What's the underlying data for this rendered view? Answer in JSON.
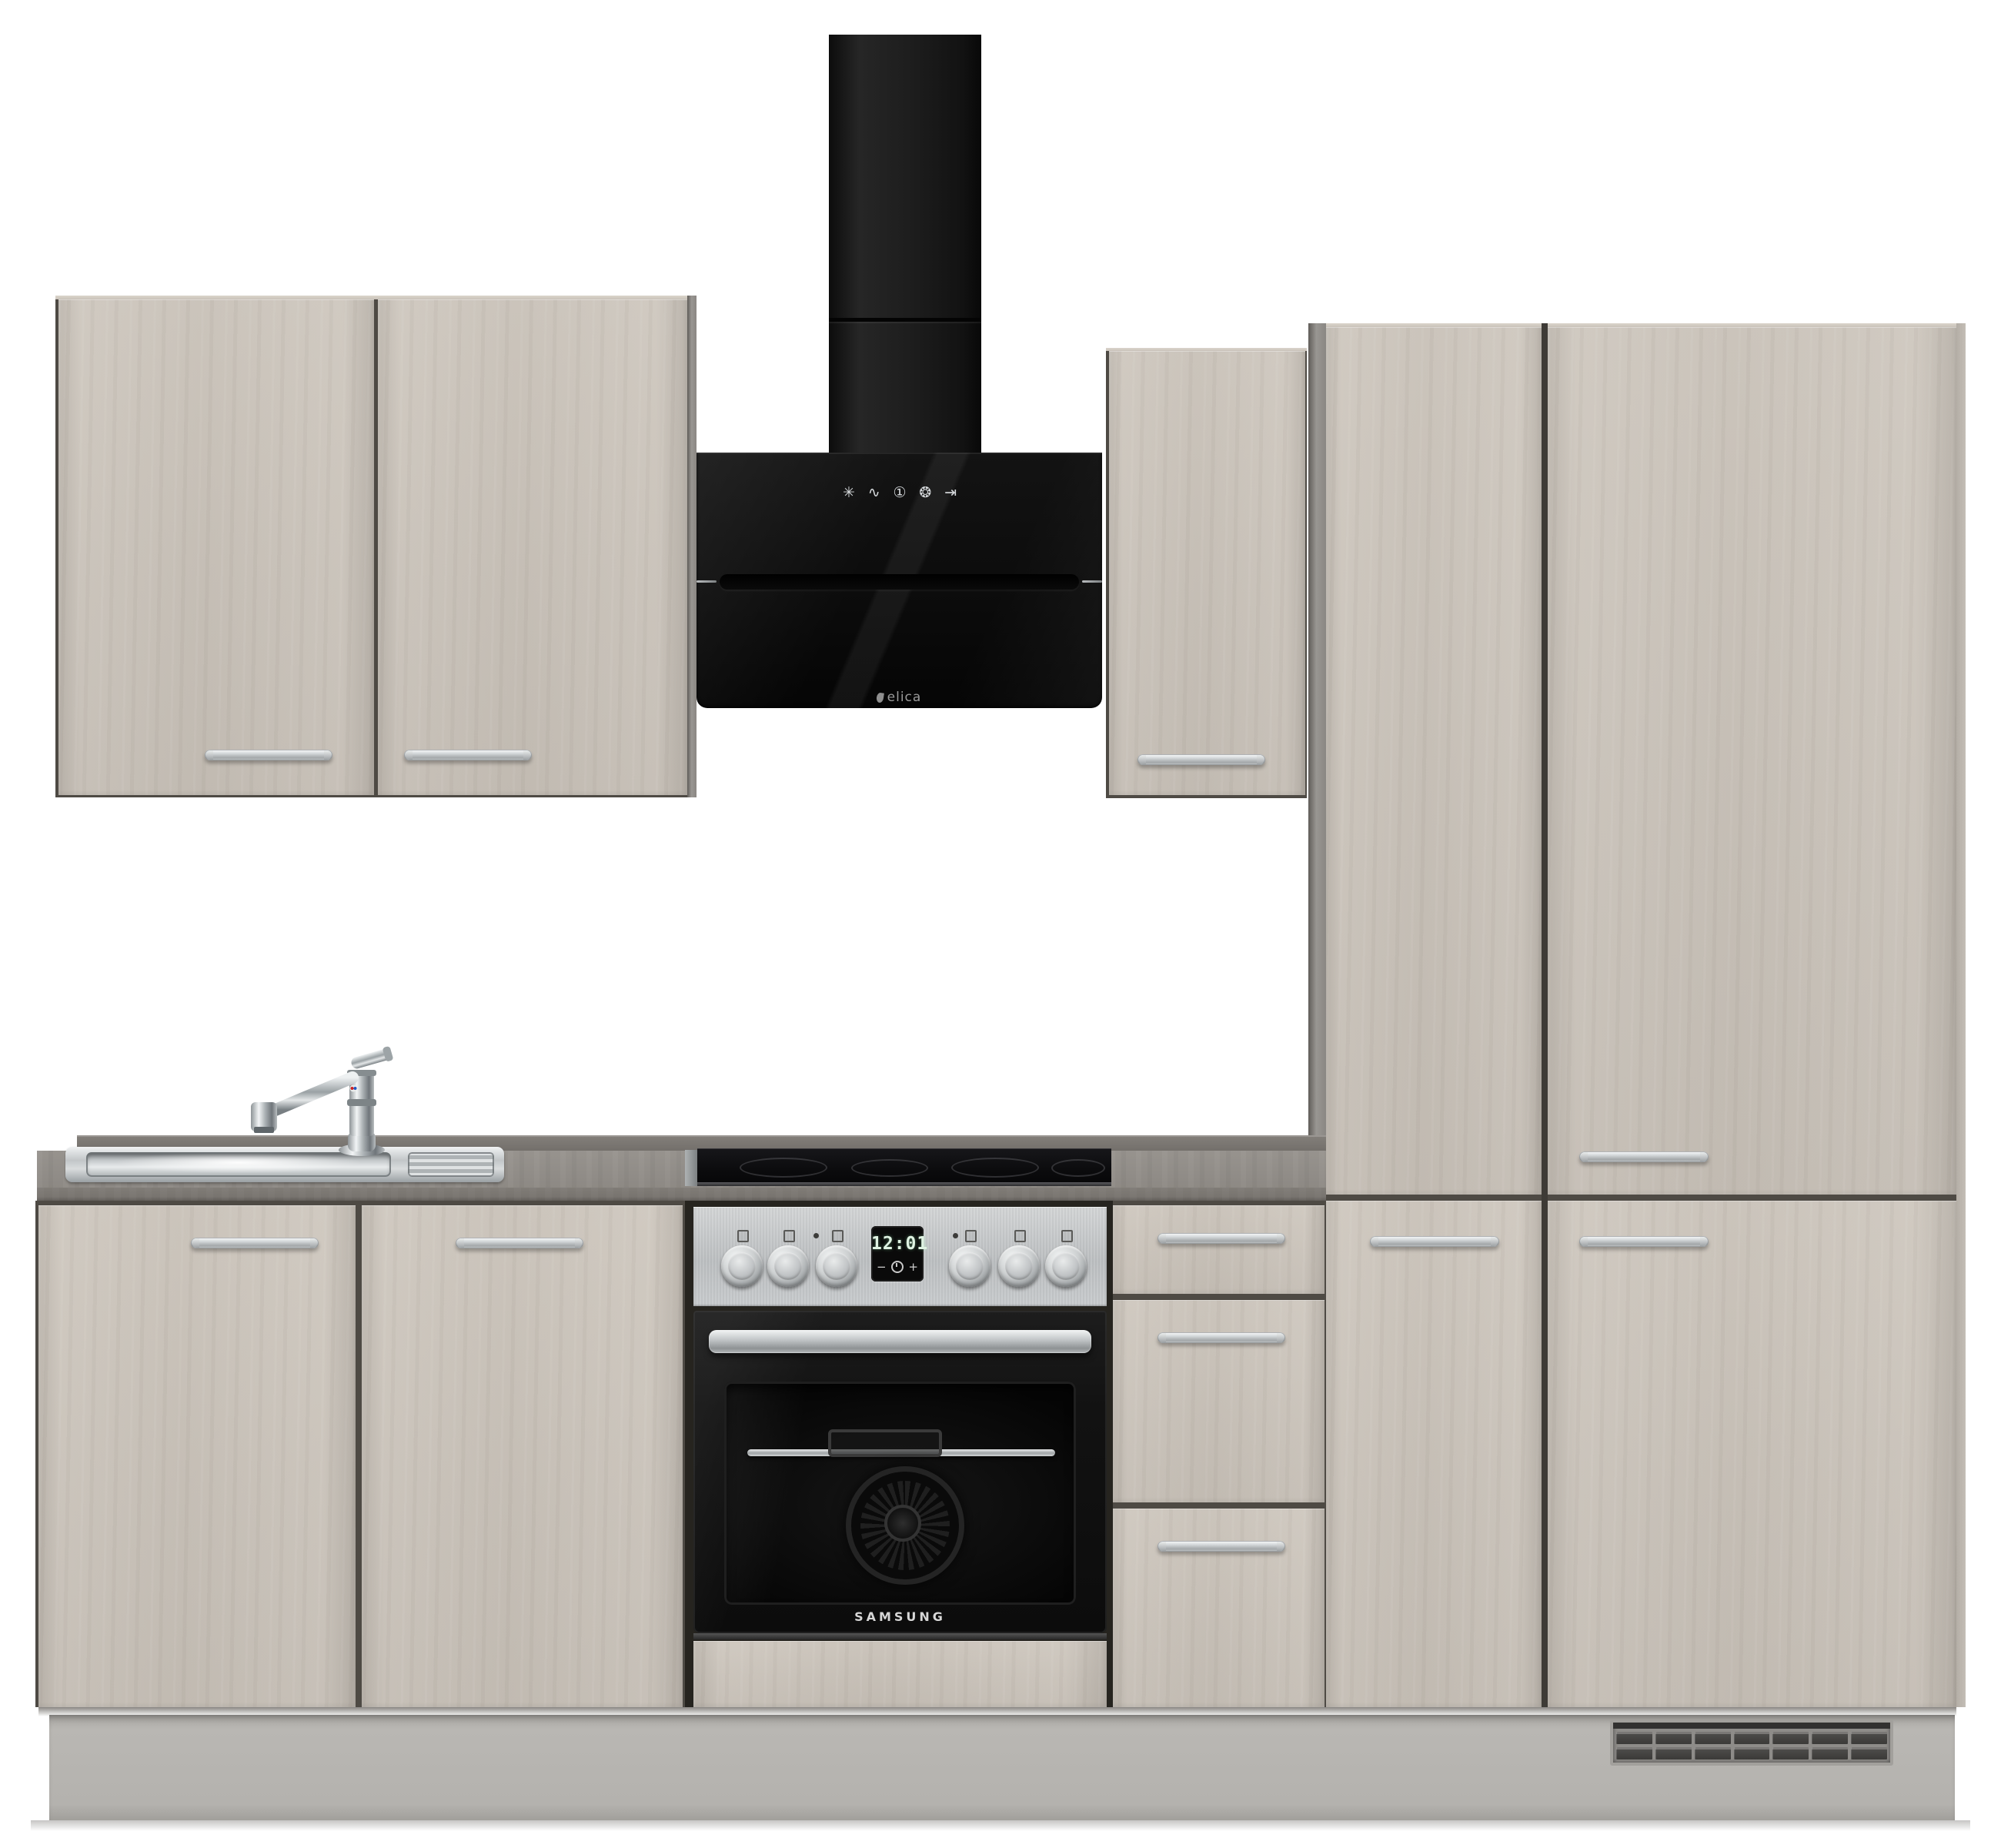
{
  "scene": {
    "type": "product-photo",
    "subject": "Kitchen unit row with appliances, concrete-beige fronts, white background",
    "background": "#ffffff"
  },
  "palette": {
    "front_concrete_beige": "#cbc4bb",
    "carcass_grey": "#8d8a86",
    "countertop_grey": "#8a8681",
    "plinth_grey": "#b8b6b2",
    "appliance_black": "#101010",
    "stainless_steel": "#c6c9cb",
    "handle_silver": "#c3c7c9"
  },
  "hood": {
    "brand": "elica",
    "style": "black glass head-free chimney hood",
    "touch_controls": [
      {
        "name": "fan-speed-icon",
        "glyph": "✳"
      },
      {
        "name": "boost-icon",
        "glyph": "∿"
      },
      {
        "name": "power-icon",
        "glyph": "①"
      },
      {
        "name": "light-icon",
        "glyph": "❂"
      },
      {
        "name": "timer-icon",
        "glyph": "⇥"
      }
    ]
  },
  "oven": {
    "brand": "SAMSUNG",
    "clock": {
      "time": "12:01",
      "minus": "−",
      "plus": "+"
    },
    "knobs": 6,
    "zone_icons": 6
  },
  "cooktop": {
    "type": "glass-ceramic hob",
    "zones": 4
  },
  "sink": {
    "type": "stainless inset sink",
    "parts": [
      "basin",
      "drainer",
      "single-lever mixer tap"
    ]
  },
  "cabinets": {
    "wall_left": {
      "doors": 2,
      "handles": 2
    },
    "wall_right": {
      "doors": 1,
      "handles": 1
    },
    "tall_left": {
      "doors": 2,
      "handles": 1
    },
    "tall_right": {
      "doors": 2,
      "handles": 2
    },
    "base_sink_unit": {
      "doors": 2,
      "handles": 2
    },
    "drawer_unit": {
      "drawers": 3,
      "handles": 3
    }
  },
  "plinth": {
    "vent_grille": {
      "rows": 2,
      "columns": 7
    }
  }
}
